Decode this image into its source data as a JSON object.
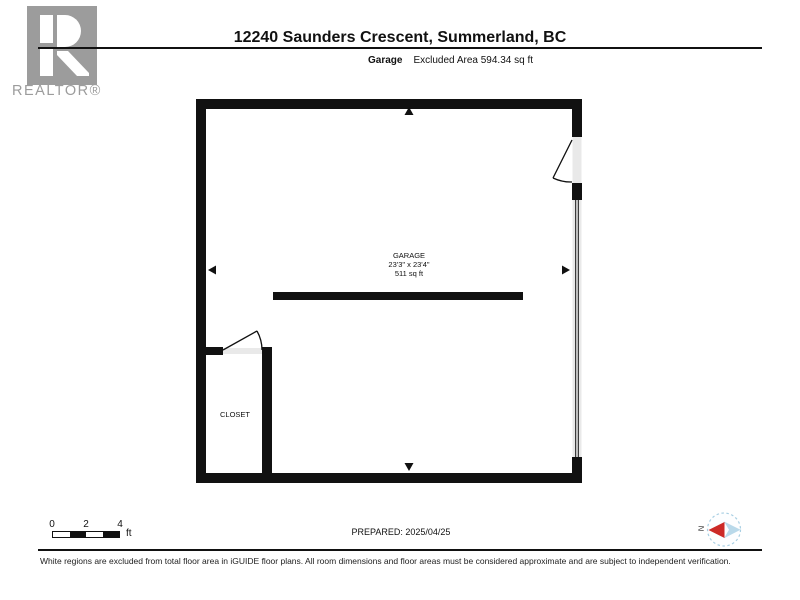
{
  "header": {
    "title": "12240 Saunders Crescent, Summerland, BC",
    "logo_wordmark": "REALTOR®",
    "subtitle_floor": "Garage",
    "subtitle_area_note": "Excluded Area 594.34 sq ft"
  },
  "floor_plan": {
    "rooms": [
      {
        "name": "GARAGE",
        "dimensions": "23'3\" x 23'4\"",
        "area": "511 sq ft"
      },
      {
        "name": "CLOSET"
      }
    ]
  },
  "footer": {
    "scale_bar": {
      "ticks": [
        "0",
        "2",
        "4"
      ],
      "unit": "ft"
    },
    "prepared": "PREPARED: 2025/04/25",
    "compass": {
      "north_label": "N"
    },
    "disclaimer": "White regions are excluded from total floor area in iGUIDE floor plans. All room dimensions and floor areas must be considered approximate and are subject to independent verification."
  },
  "colors": {
    "wall": "#111111",
    "door_opening": "#e9e9e9",
    "logo_grey": "#9c9c9c",
    "compass_red": "#cc2a27",
    "compass_blue": "#b9d9ea"
  }
}
